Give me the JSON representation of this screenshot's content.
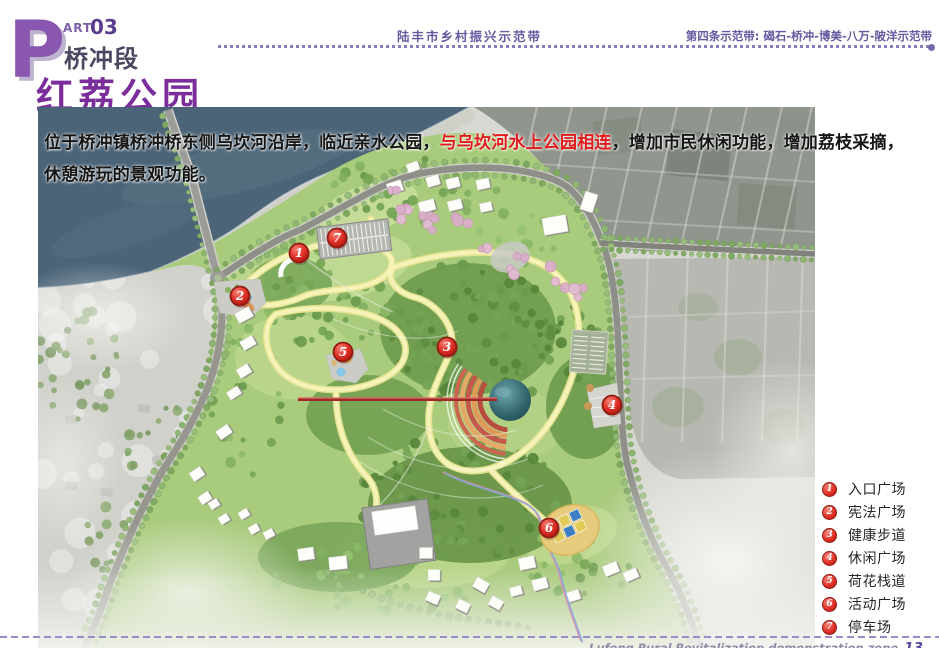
{
  "header": {
    "part_letter": "P",
    "part_label": "ART",
    "part_number": "03",
    "section": "桥冲段",
    "title": "红荔公园",
    "center_banner": "陆丰市乡村振兴示范带",
    "right_banner": "第四条示范带: 碣石-桥冲-博美-八万-陂洋示范带"
  },
  "description": {
    "pre": "位于桥冲镇桥冲桥东侧乌坎河沿岸，临近亲水公园，",
    "highlight": "与乌坎河水上公园相连",
    "post": "，增加市民休闲功能，增加荔枝采摘，休憩游玩的景观功能。"
  },
  "legend": {
    "items": [
      {
        "num": "1",
        "label": "入口广场",
        "x": 261,
        "y": 146
      },
      {
        "num": "2",
        "label": "宪法广场",
        "x": 202,
        "y": 189
      },
      {
        "num": "3",
        "label": "健康步道",
        "x": 409,
        "y": 240
      },
      {
        "num": "4",
        "label": "休闲广场",
        "x": 574,
        "y": 298
      },
      {
        "num": "5",
        "label": "荷花栈道",
        "x": 305,
        "y": 245
      },
      {
        "num": "6",
        "label": "活动广场",
        "x": 511,
        "y": 421
      },
      {
        "num": "7",
        "label": "停车场",
        "x": 299,
        "y": 131
      }
    ],
    "marker_color": "#e23128",
    "marker_border": "#8f1d14"
  },
  "footer": {
    "text": "Lufeng Rural Revitalization demonstration zone",
    "page": "13"
  },
  "colors": {
    "accent_purple": "#7b2e9b",
    "banner_purple": "#685aa0",
    "highlight_red": "#e01a1a",
    "water_blue": "#4b6478",
    "park_green": "#a9cb7c"
  }
}
